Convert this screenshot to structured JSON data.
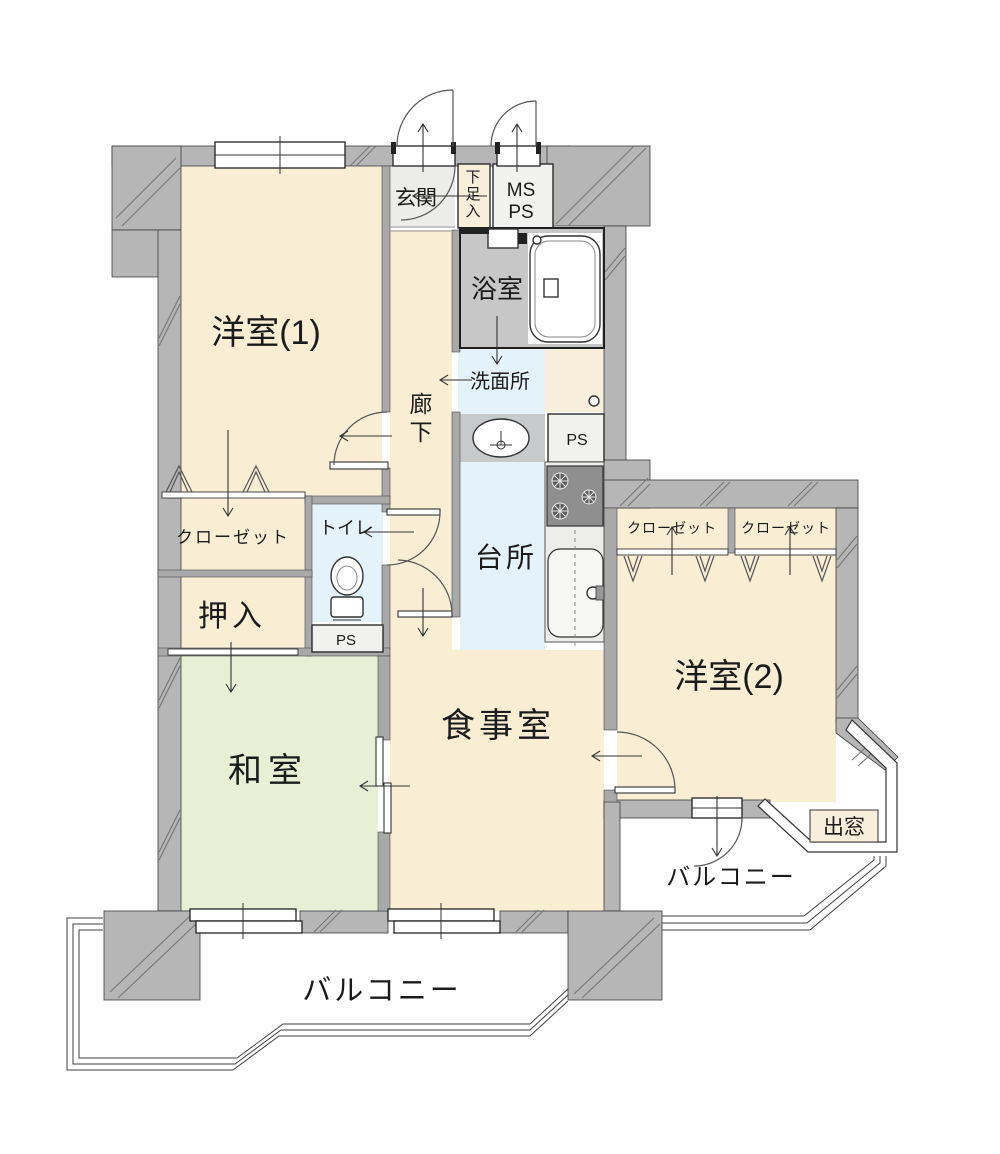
{
  "labels": {
    "yoshitsu1": "洋室(1)",
    "genkan": "玄関",
    "getabako": "下足入",
    "ms": "MS",
    "ps_meter": "PS",
    "bath": "浴室",
    "senmenjo": "洗面所",
    "ps_laundry": "PS",
    "kitchen": "台所",
    "rouka": "廊下",
    "toilet": "トイレ",
    "ps_toilet": "PS",
    "closet_left": "クローゼット",
    "oshiire": "押入",
    "washitsu": "和室",
    "dining": "食事室",
    "yoshitsu2": "洋室(2)",
    "closet_right1": "クローゼット",
    "closet_right2": "クローゼット",
    "demado": "出窓",
    "balcony_right": "バルコニー",
    "balcony_main": "バルコニー"
  },
  "colors": {
    "wall": "#b6b6b6",
    "wall_inner": "#a9a9a9",
    "outline": "#3c3c3c",
    "cream": "#f9edd4",
    "cream_light": "#f7efdc",
    "tatami": "#e9efd4",
    "water": "#e4f2f9",
    "bath_floor": "#c7c7c7",
    "entry_floor": "#ececea",
    "box_floor": "#f1f1ef",
    "laundry_floor": "#c6cacb",
    "counter": "#ededeb",
    "stove": "#8f8f8f",
    "text": "#1b1b1b"
  }
}
